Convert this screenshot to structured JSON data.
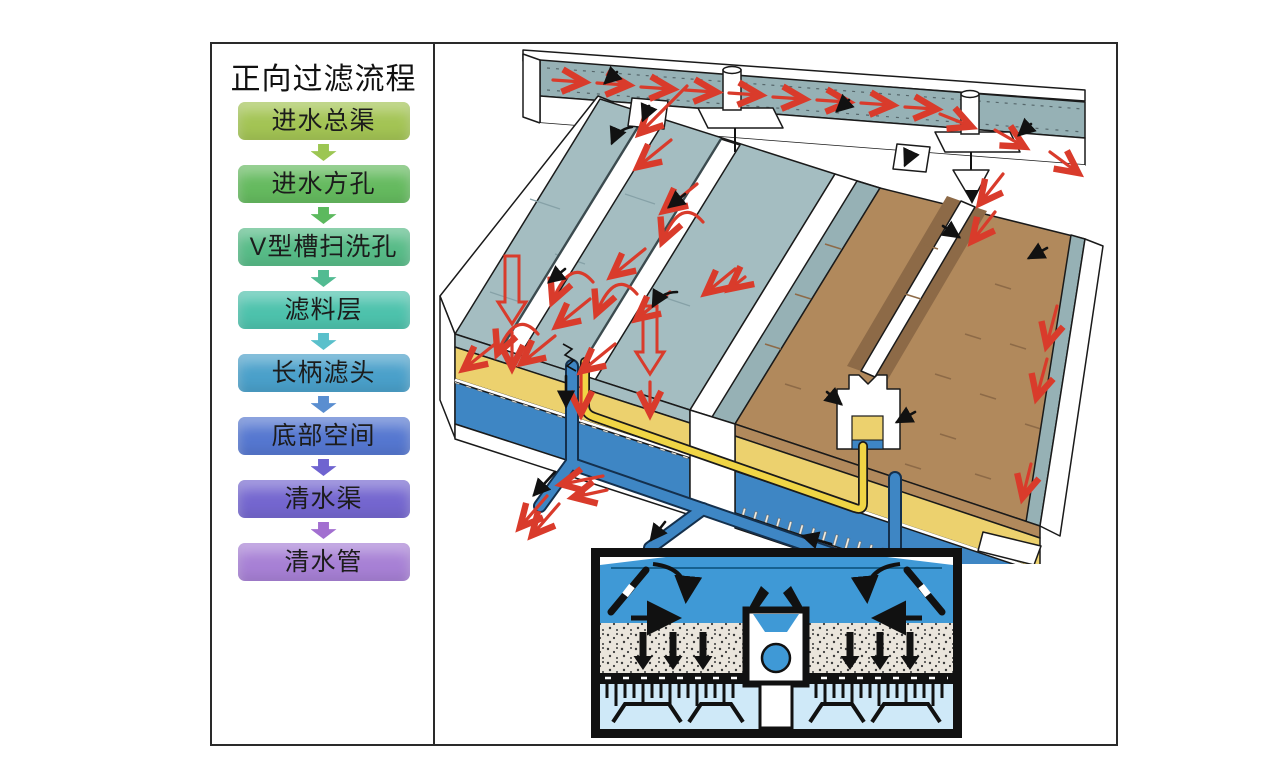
{
  "window": {
    "background": "#ffffff",
    "border_color": "#2a2a2a"
  },
  "flowchart": {
    "title": "正向过滤流程",
    "steps": [
      {
        "label": "进水总渠",
        "color": "#a3c454",
        "arrow_color": "#9cc653"
      },
      {
        "label": "进水方孔",
        "color": "#65ba5f",
        "arrow_color": "#5cb95e"
      },
      {
        "label": "V型槽扫洗孔",
        "color": "#57bb87",
        "arrow_color": "#52bb92"
      },
      {
        "label": "滤料层",
        "color": "#4dc2ac",
        "arrow_color": "#5ac0cb"
      },
      {
        "label": "长柄滤头",
        "color": "#4aa0ca",
        "arrow_color": "#5a8ed0"
      },
      {
        "label": "底部空间",
        "color": "#5577d0",
        "arrow_color": "#6f64d0"
      },
      {
        "label": "清水渠",
        "color": "#7466cf",
        "arrow_color": "#a26fd0"
      },
      {
        "label": "清水管",
        "color": "#a780d5",
        "arrow_color": ""
      }
    ]
  },
  "diagram": {
    "colors": {
      "water_surface": "#a4bdc1",
      "channel_water": "#96b1b5",
      "sand_brown": "#b1895c",
      "sand_shadow": "#8d6a47",
      "sand_yellow": "#ecd16e",
      "pipe_blue": "#3e86c4",
      "pipe_yellow": "#f0d545",
      "section_water": "#3f99d6",
      "plenum_blue": "#cfe9f8",
      "flow_arrow_red": "#d93b2b",
      "outline_dark": "#1a1a1a"
    }
  }
}
